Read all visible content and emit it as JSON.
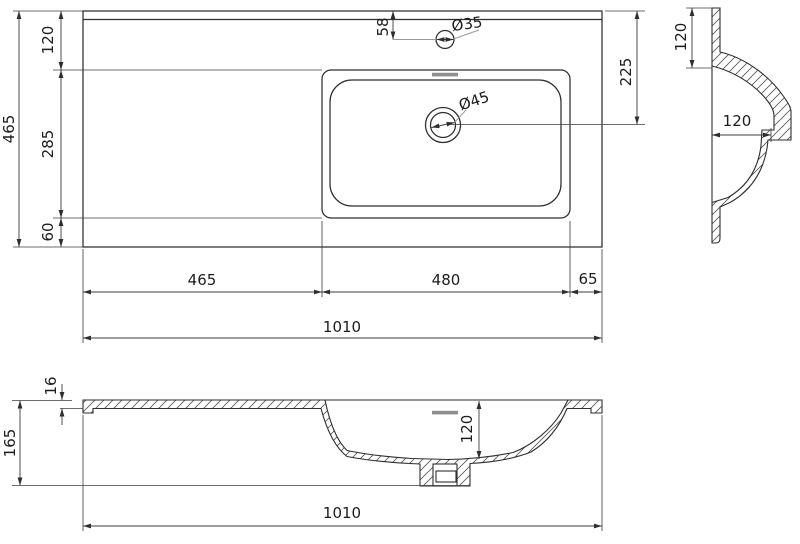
{
  "title": "Washbasin technical drawing, three orthographic section views",
  "colors": {
    "line": "#2e2e2e",
    "dimension": "#3c3c3c",
    "leader_gray": "#9b9b9b",
    "slot_gray": "#8f8f8f",
    "background": "#ffffff"
  },
  "plan": {
    "total_depth": "465",
    "back_offset": "120",
    "basin_depth": "285",
    "front_offset": "60",
    "faucet_offset": "58",
    "faucet_diameter": "Ø35",
    "drain_diameter": "Ø45",
    "drain_offset": "225",
    "left_section": "465",
    "basin_width": "480",
    "right_section": "65",
    "total_width": "1010"
  },
  "side": {
    "back_depth": "120",
    "bowl_depth": "120"
  },
  "front": {
    "top_thickness": "16",
    "total_height": "165",
    "bowl_depth": "120",
    "total_width": "1010"
  }
}
